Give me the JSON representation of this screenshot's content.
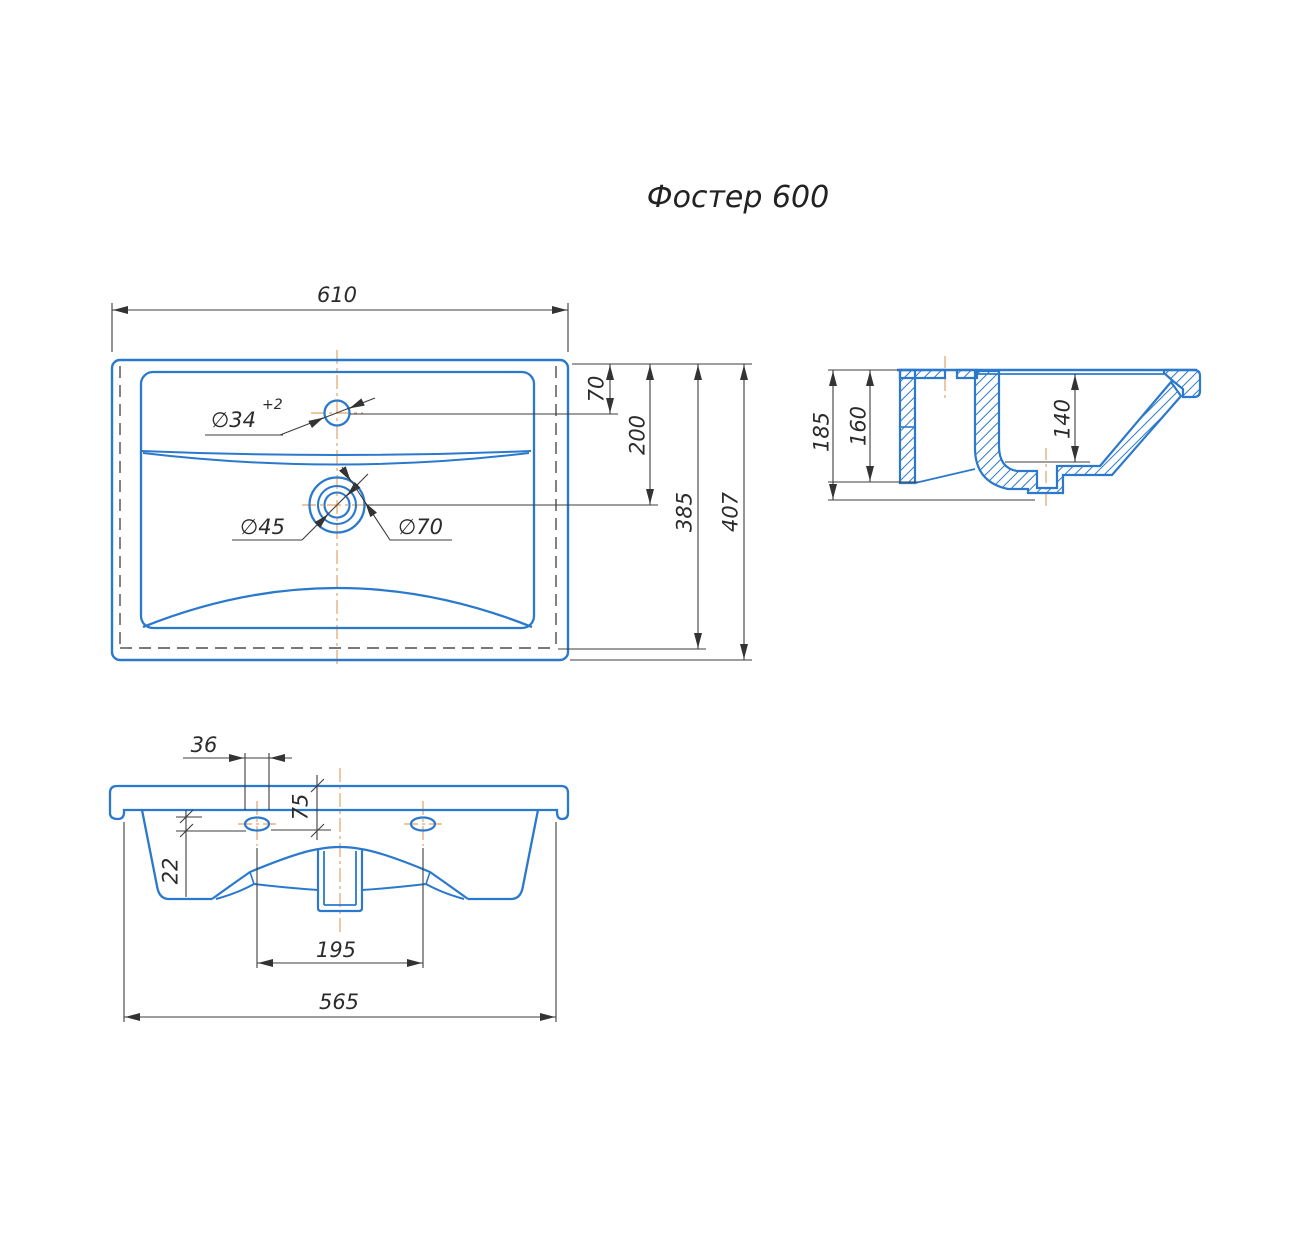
{
  "title": "Фостер 600",
  "drawing_type": "sink-dimension-drawing",
  "colors": {
    "part_line": "#2b79cc",
    "dimension_line": "#3d3d3d",
    "hidden_line": "#4d4d4d",
    "centerline": "#e2a468",
    "background": "#ffffff"
  },
  "views": {
    "top": {
      "label": "plan-view",
      "dims": {
        "width_total": "610",
        "faucet_offset": "70",
        "drain_offset": "200",
        "depth_inner": "385",
        "depth_total": "407",
        "faucet_hole_dia": "∅34",
        "faucet_hole_tol": "+2",
        "drain_inner_dia": "∅45",
        "drain_outer_dia": "∅70"
      }
    },
    "section": {
      "label": "side-section-view",
      "dims": {
        "height_total": "185",
        "height_back": "160",
        "basin_depth": "140"
      }
    },
    "front": {
      "label": "front-view",
      "dims": {
        "slot_width": "36",
        "slot_top_offset": "75",
        "slot_height": "22",
        "holes_spacing": "195",
        "width_bottom": "565"
      }
    }
  }
}
